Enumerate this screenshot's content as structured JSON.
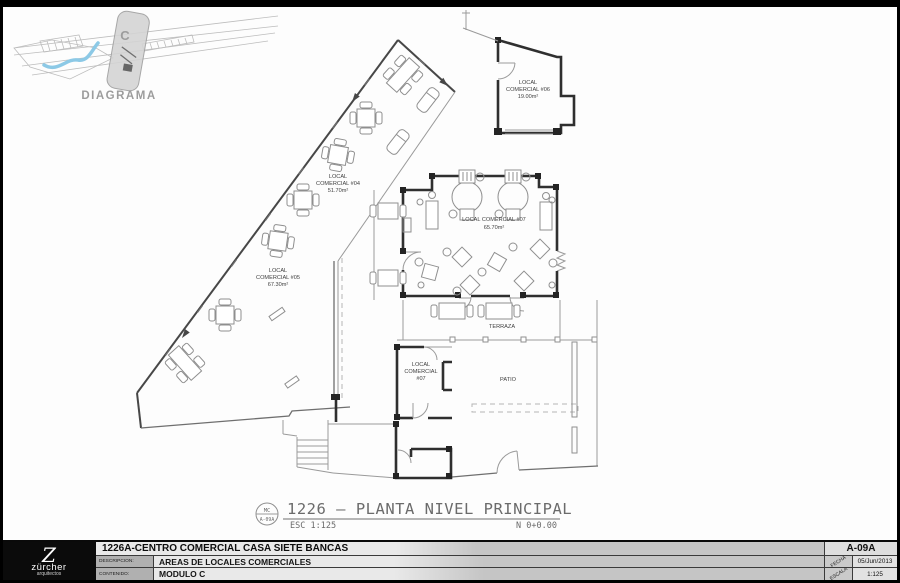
{
  "colors": {
    "frame": "#000000",
    "paper": "#fdfdfd",
    "wall": "#2f2f2f",
    "thin_line": "#9a9a9a",
    "furniture": "#8f8f8f",
    "river_blue": "#8cc9e6",
    "highlight_grey": "#d4d4d4",
    "label_text": "#3f3f3f",
    "cad_text": "#6b6b6b"
  },
  "diagram": {
    "label": "DIAGRAMA",
    "module_letter": "C"
  },
  "plan": {
    "title": "1226 – PLANTA NIVEL PRINCIPAL",
    "scale_note": "ESC 1:125",
    "level_note": "N 0+0.00",
    "ref_top": "MC",
    "ref_bottom": "A-09A",
    "terraza": "TERRAZA",
    "patio": "PATIO",
    "locals": {
      "l04": {
        "line1": "LOCAL",
        "line2": "COMERCIAL #04",
        "area": "51.70m²"
      },
      "l05": {
        "line1": "LOCAL",
        "line2": "COMERCIAL #05",
        "area": "67.30m²"
      },
      "l06": {
        "line1": "LOCAL",
        "line2": "COMERCIAL #06",
        "area": "19.00m²"
      },
      "l07": {
        "label": "LOCAL COMERCIAL #07",
        "area": "65.70m²"
      },
      "l07b": {
        "line1": "LOCAL",
        "line2": "COMERCIAL",
        "line3": "#07"
      }
    }
  },
  "titleblock": {
    "project": "1226A-CENTRO COMERCIAL CASA SIETE BANCAS",
    "descripcion_label": "DESCRIPCION:",
    "descripcion": "AREAS DE LOCALES COMERCIALES",
    "contenido_label": "CONTENIDO:",
    "contenido": "MODULO C",
    "sheet": "A-09A",
    "fecha_label": "FECHA",
    "fecha": "05/Jun/2013",
    "escala_label": "ESCALA",
    "escala": "1:125",
    "logo_letter": "Z",
    "logo_name": "zürcher",
    "logo_sub": "arquitectos"
  }
}
